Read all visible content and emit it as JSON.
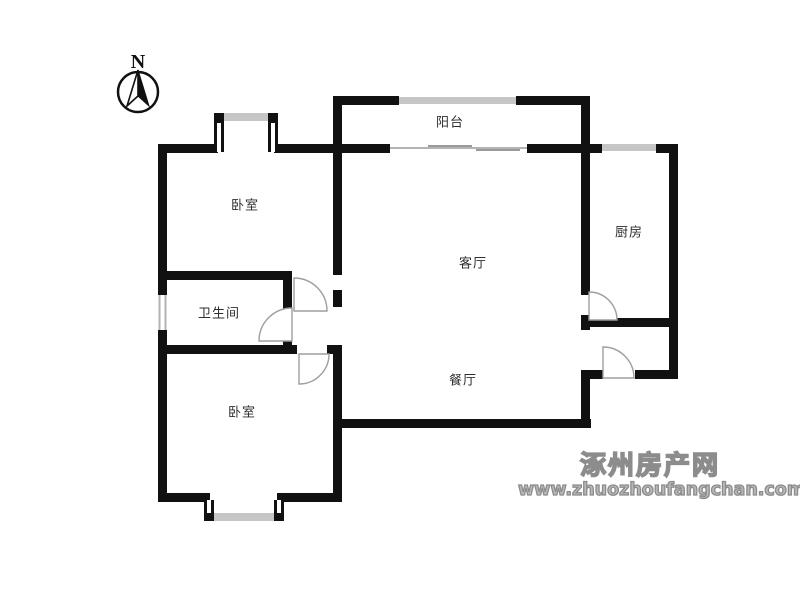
{
  "compass": {
    "label": "N"
  },
  "rooms": [
    {
      "name": "balcony",
      "label": "阳台"
    },
    {
      "name": "bedroom-north",
      "label": "卧室"
    },
    {
      "name": "kitchen",
      "label": "厨房"
    },
    {
      "name": "living-room",
      "label": "客厅"
    },
    {
      "name": "bathroom",
      "label": "卫生间"
    },
    {
      "name": "dining-room",
      "label": "餐厅"
    },
    {
      "name": "bedroom-south",
      "label": "卧室"
    }
  ],
  "watermark": {
    "site_name": "涿州房产网",
    "site_url": "www.zhuozhoufangchan.com"
  },
  "colors": {
    "background": "#ffffff",
    "wall": "#111111",
    "window": "#c6c6c6",
    "door_arc": "#9e9e9e",
    "room_label": "#2e2e2e",
    "watermark": "#8c8c8c"
  }
}
